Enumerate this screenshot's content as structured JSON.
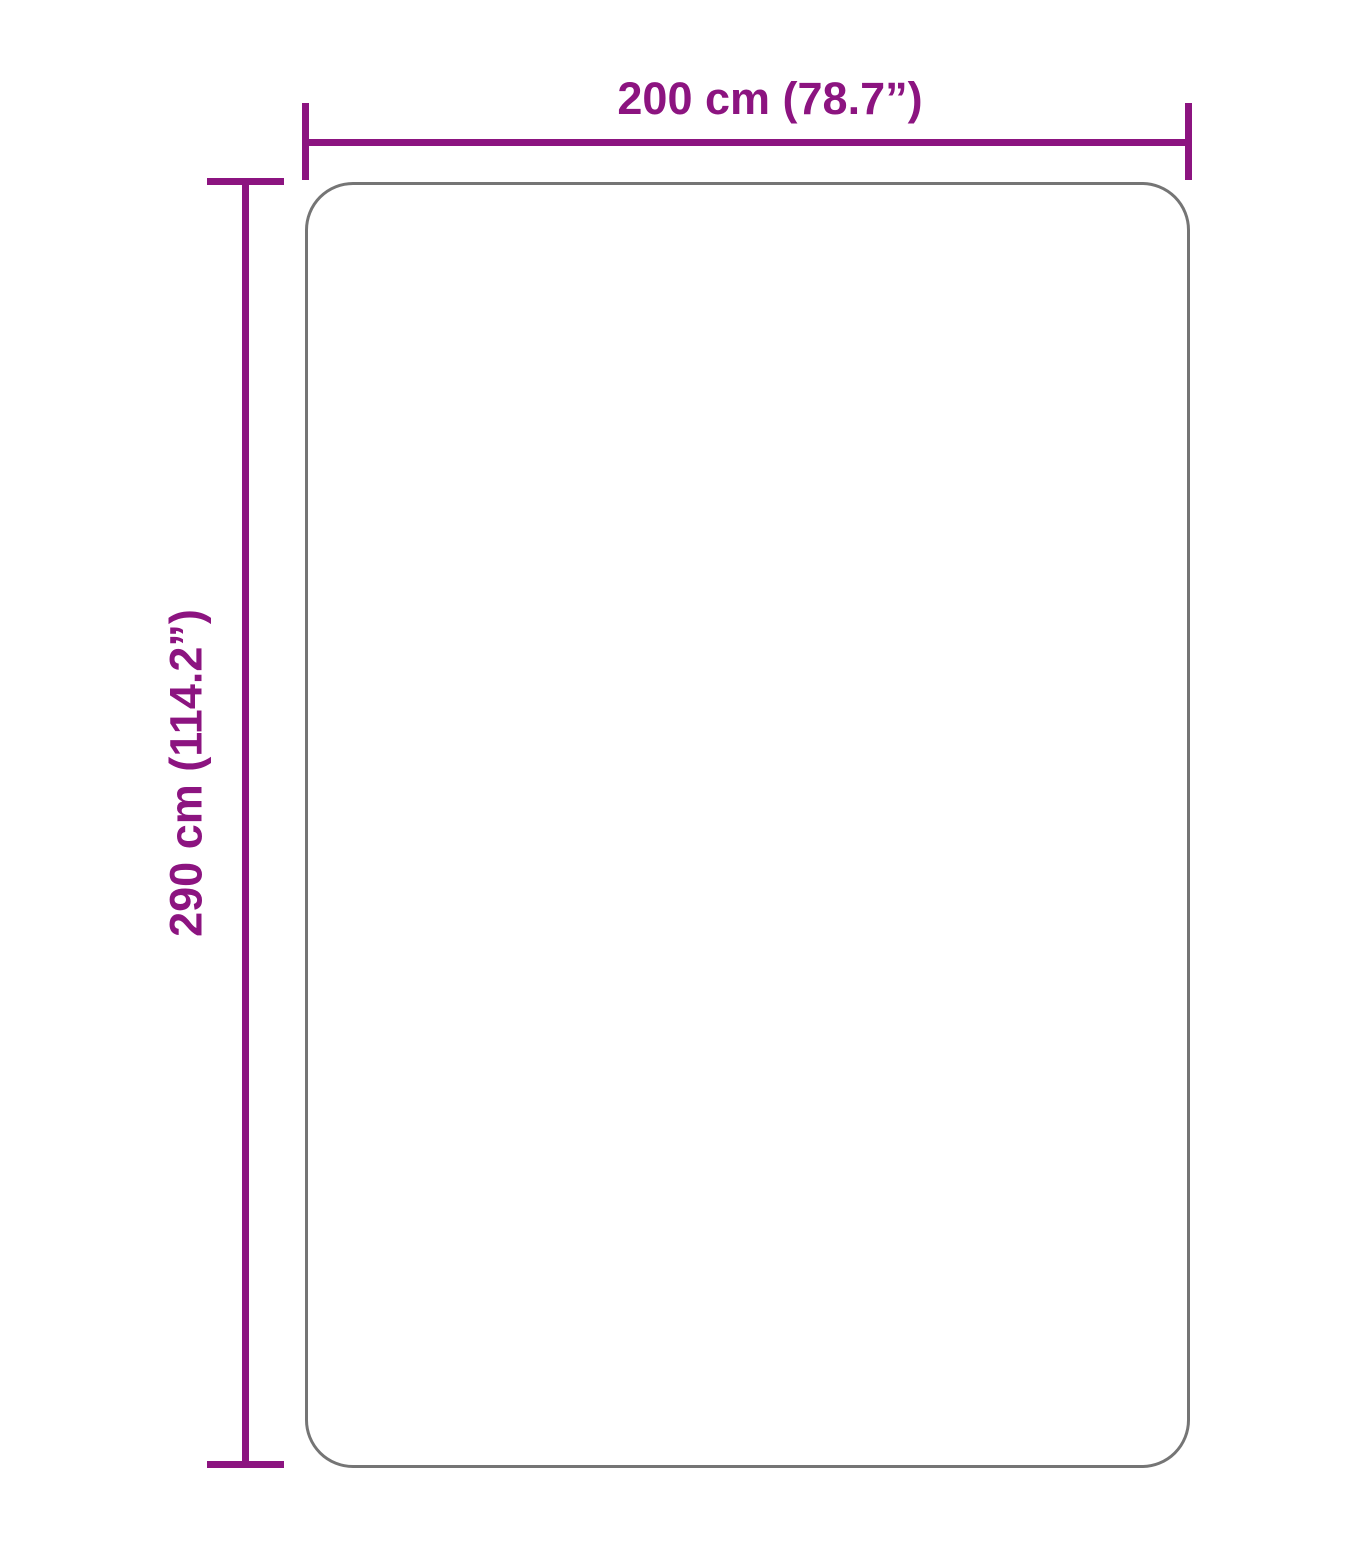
{
  "diagram": {
    "width_dimension": {
      "label": "200 cm (78.7”)"
    },
    "height_dimension": {
      "label": "290 cm (114.2”)"
    },
    "colors": {
      "dimension-color": "#8c1480",
      "outline-color": "#757575",
      "background-color": "#ffffff"
    }
  }
}
